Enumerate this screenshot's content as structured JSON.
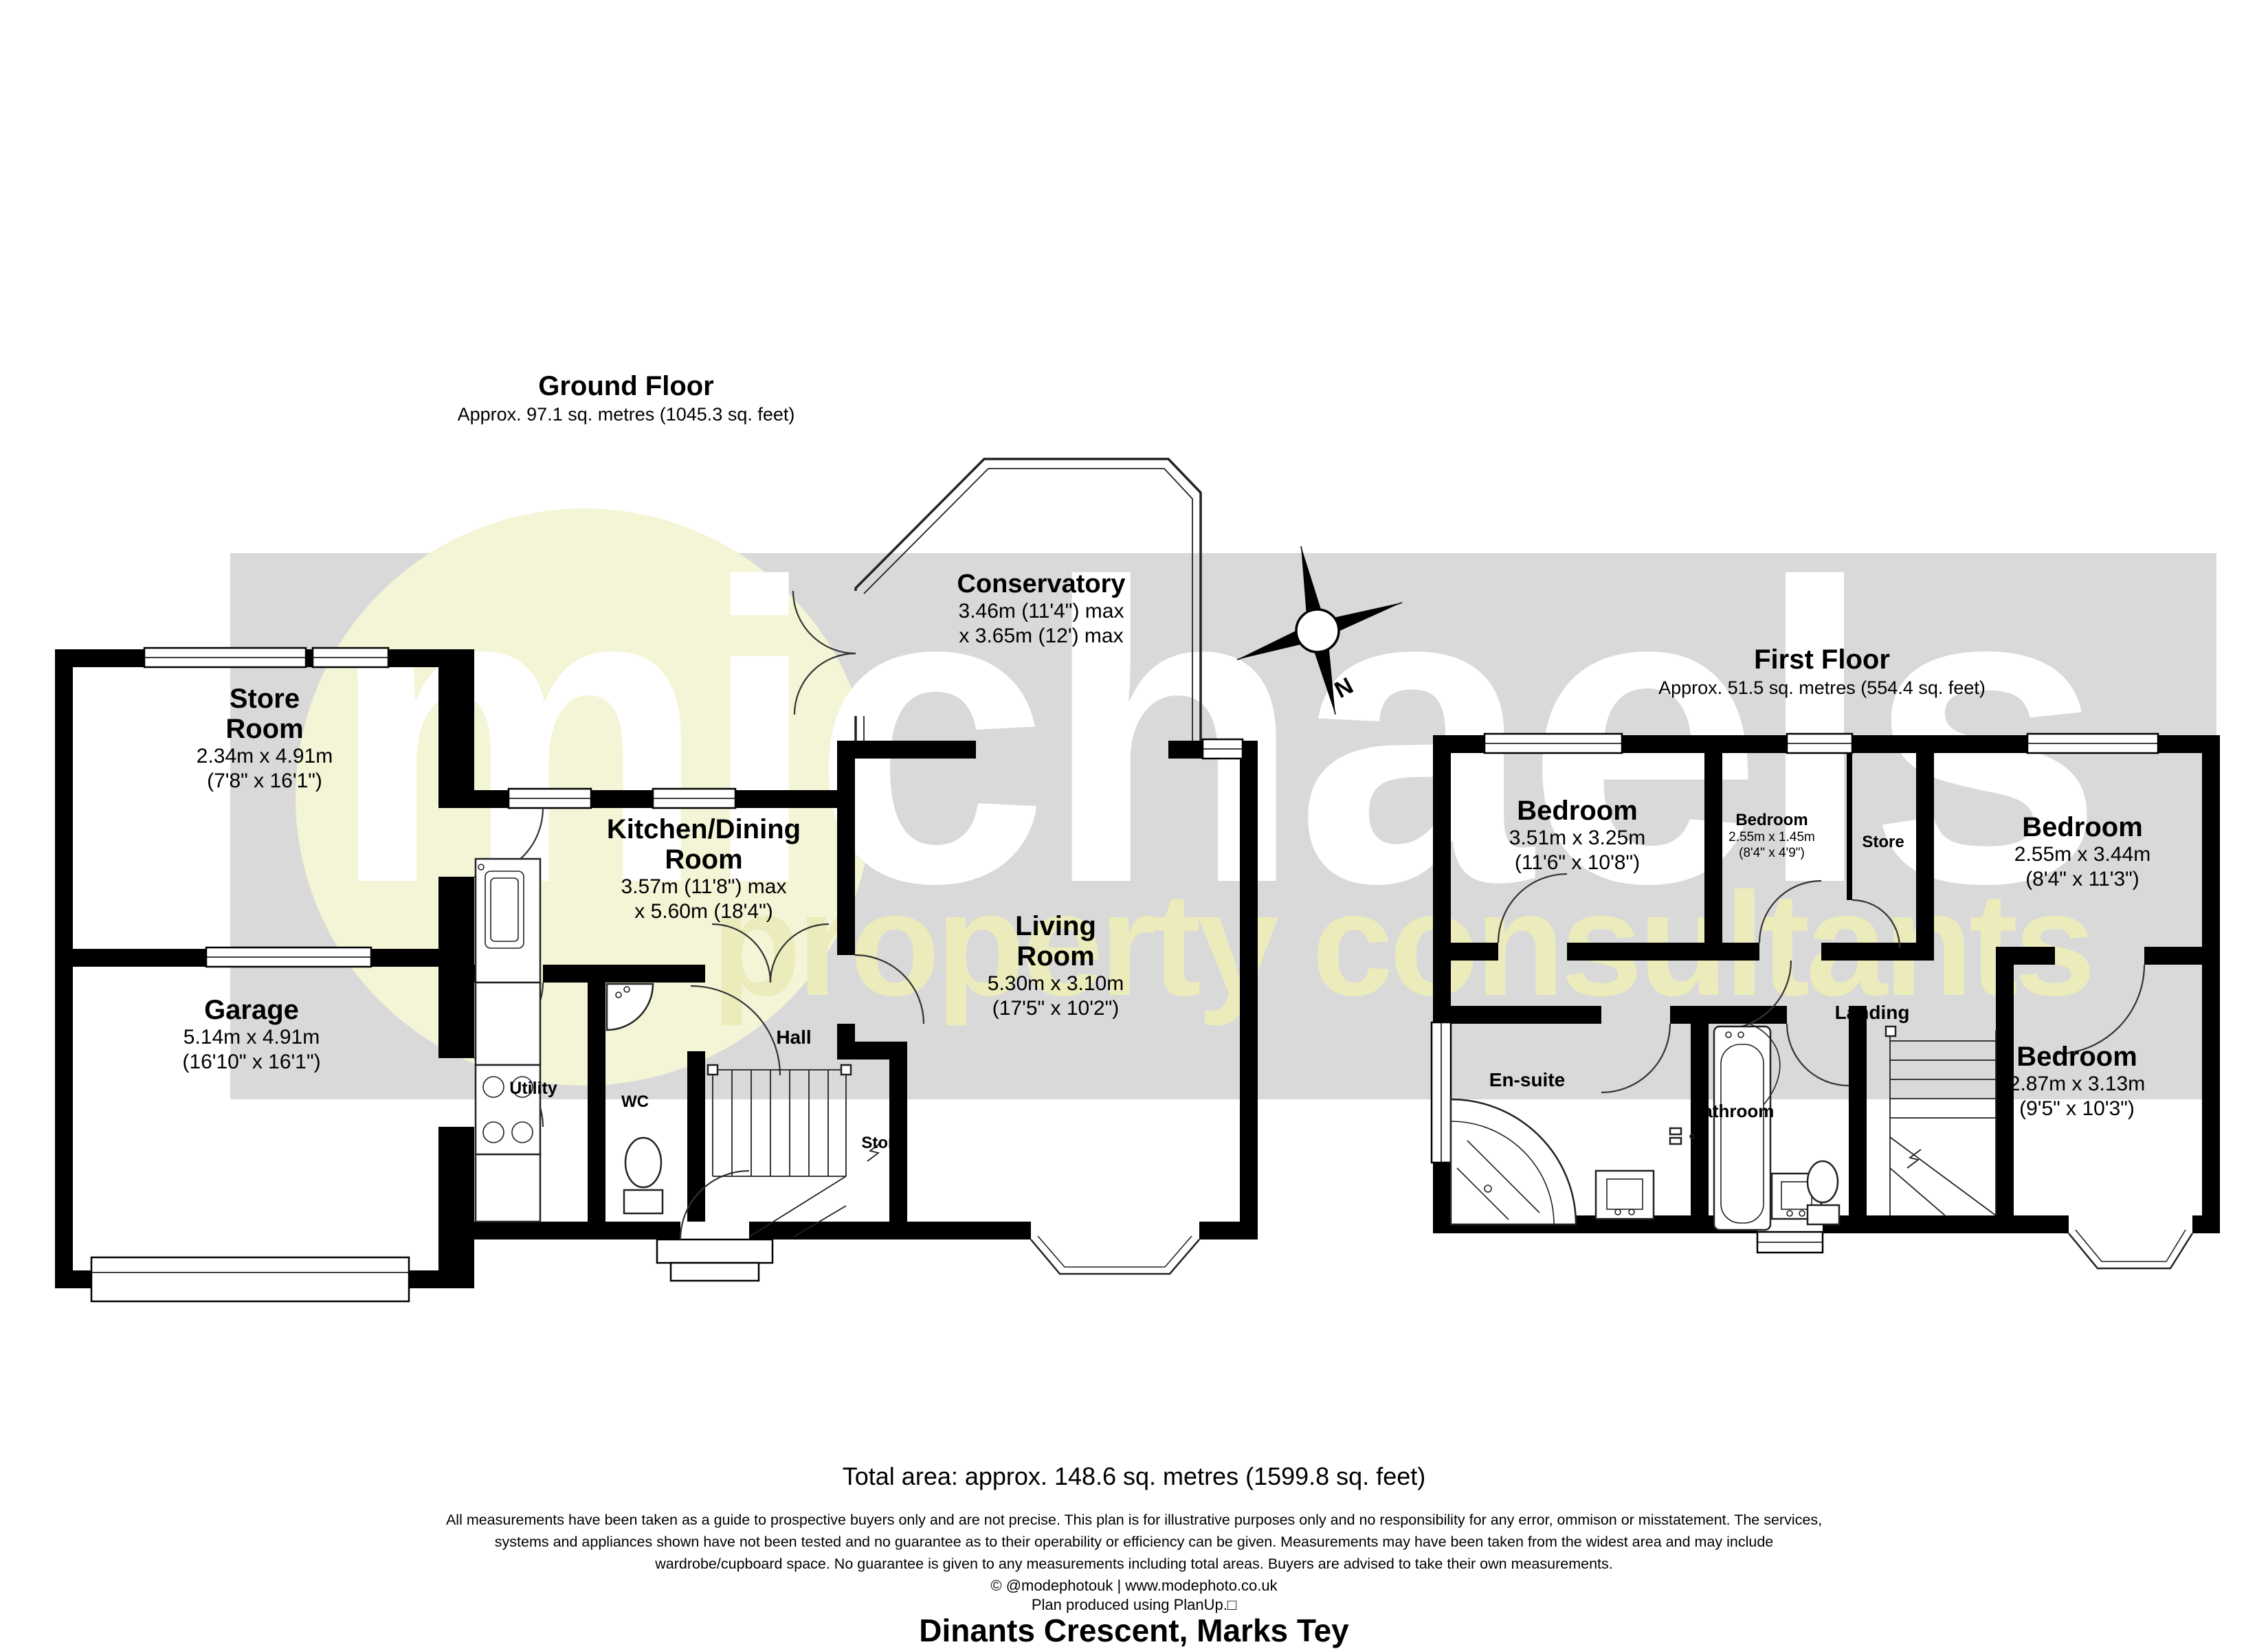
{
  "watermark": {
    "word": "michaels",
    "tagline": "property consultants"
  },
  "compass": {
    "north_label": "N"
  },
  "ground_floor": {
    "title": "Ground Floor",
    "subtitle": "Approx. 97.1 sq. metres (1045.3 sq. feet)",
    "rooms": {
      "conservatory": {
        "name": "Conservatory",
        "dims1": "3.46m (11'4\") max",
        "dims2": "x 3.65m (12') max"
      },
      "store_room": {
        "name": "Store\nRoom",
        "dims1": "2.34m x 4.91m",
        "dims2": "(7'8\" x 16'1\")"
      },
      "kitchen": {
        "name": "Kitchen/Dining\nRoom",
        "dims1": "3.57m (11'8\") max",
        "dims2": "x 5.60m (18'4\")"
      },
      "living_room": {
        "name": "Living\nRoom",
        "dims1": "5.30m x 3.10m",
        "dims2": "(17'5\" x 10'2\")"
      },
      "garage": {
        "name": "Garage",
        "dims1": "5.14m x 4.91m",
        "dims2": "(16'10\" x 16'1\")"
      },
      "hall": {
        "name": "Hall"
      },
      "utility": {
        "name": "Utility"
      },
      "wc": {
        "name": "WC"
      },
      "store": {
        "name": "Store"
      }
    }
  },
  "first_floor": {
    "title": "First Floor",
    "subtitle": "Approx. 51.5 sq. metres (554.4 sq. feet)",
    "rooms": {
      "bedroom_1": {
        "name": "Bedroom",
        "dims1": "3.51m x 3.25m",
        "dims2": "(11'6\" x 10'8\")"
      },
      "bedroom_2": {
        "name": "Bedroom",
        "dims1": "2.55m x 1.45m",
        "dims2": "(8'4\" x 4'9\")"
      },
      "store": {
        "name": "Store"
      },
      "bedroom_3": {
        "name": "Bedroom",
        "dims1": "2.55m x 3.44m",
        "dims2": "(8'4\" x 11'3\")"
      },
      "bedroom_4": {
        "name": "Bedroom",
        "dims1": "2.87m x 3.13m",
        "dims2": "(9'5\" x 10'3\")"
      },
      "en_suite": {
        "name": "En-suite"
      },
      "bathroom": {
        "name": "Bathroom"
      },
      "landing": {
        "name": "Landing"
      }
    }
  },
  "summary": {
    "total_area": "Total area: approx. 148.6 sq. metres (1599.8 sq. feet)",
    "disclaimer": "All measurements have been taken as a guide to prospective buyers only and are not precise. This plan is for illustrative purposes only and no responsibility for any error, ommison or misstatement. The services,\nsystems and appliances shown have not been tested and no guarantee as to their operability or efficiency can be given. Measurements may have been taken from the widest area and may include\nwardrobe/cupboard space. No guarantee is given to any measurements including total areas. Buyers are advised to take their own measurements.",
    "credit": "© @modephotouk | www.modephoto.co.uk",
    "produced": "Plan produced using PlanUp.□",
    "address": "Dinants Crescent, Marks Tey"
  }
}
